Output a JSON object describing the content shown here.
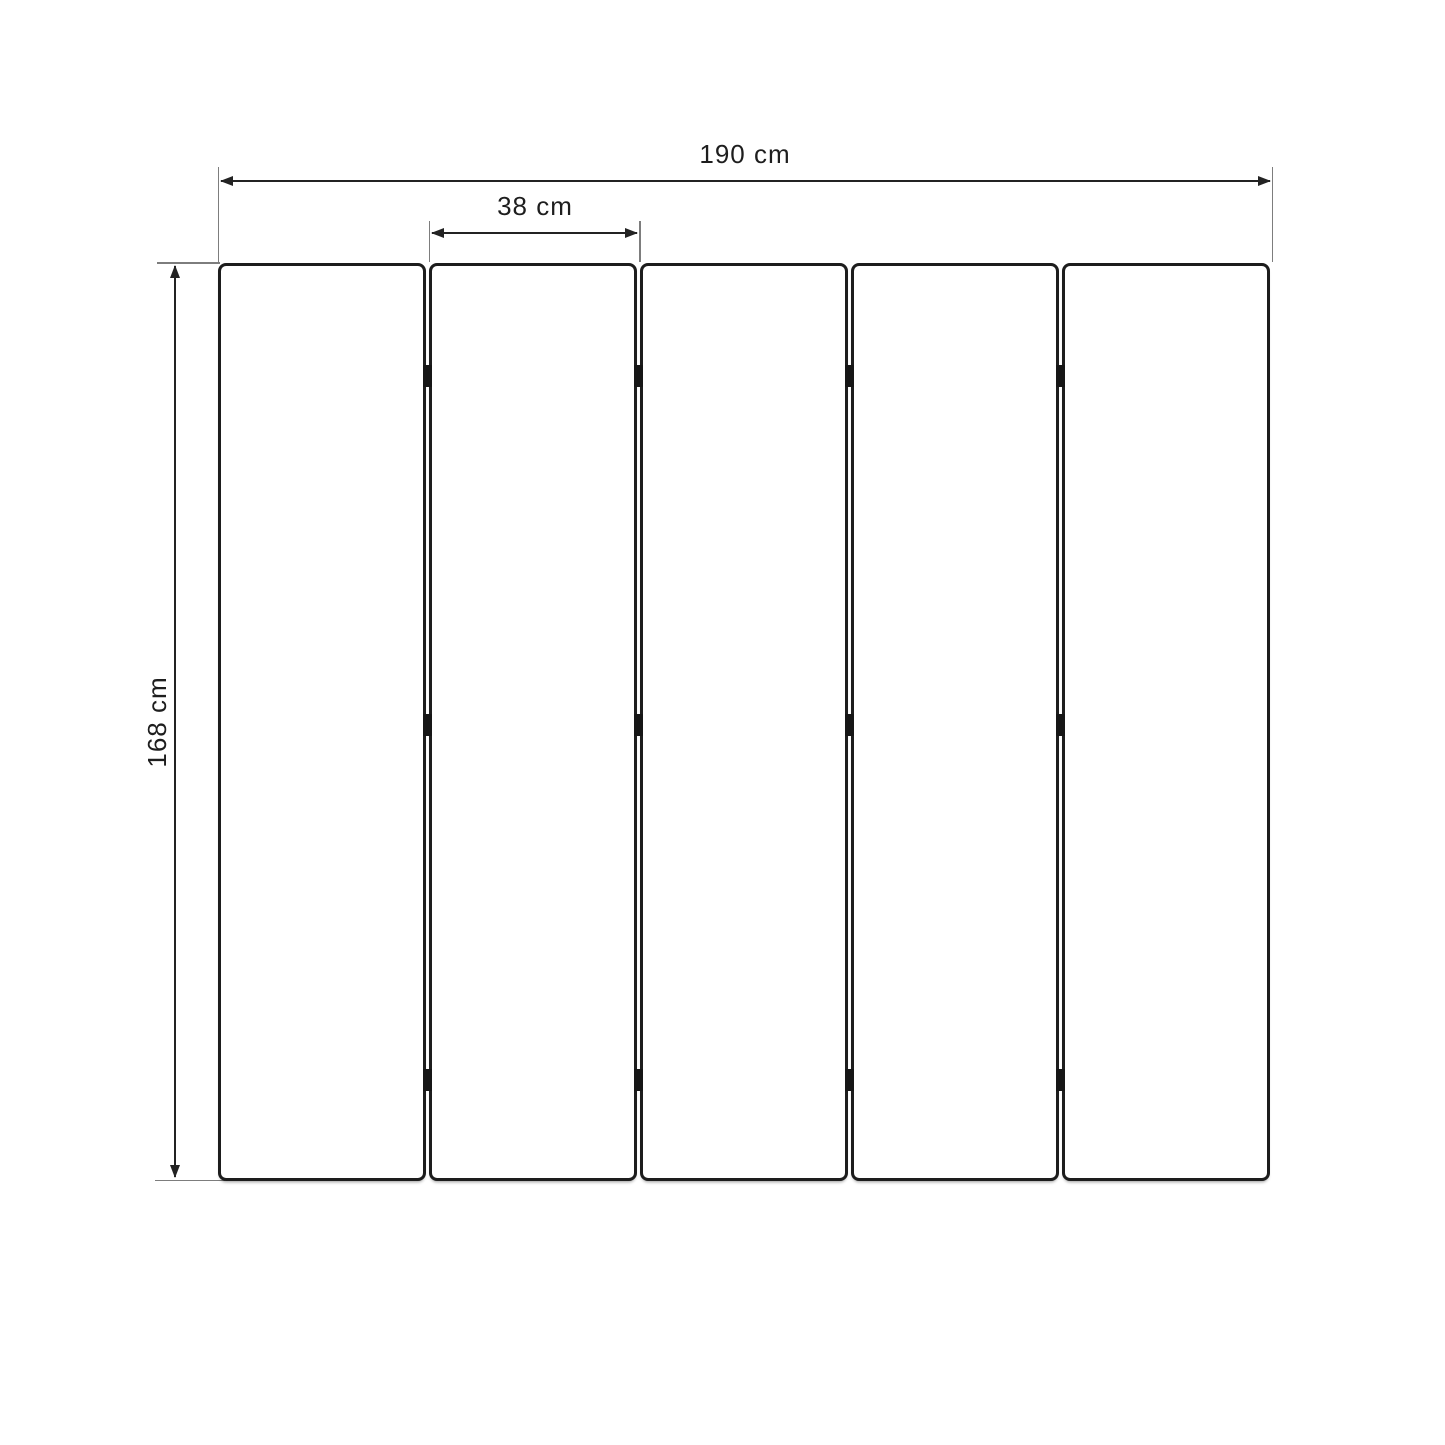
{
  "diagram": {
    "type": "technical-dimension-drawing",
    "subject": "five-panel folding screen (front view)",
    "dimensions": {
      "total_width": {
        "label": "190 cm"
      },
      "panel_width": {
        "label": "38 cm"
      },
      "height": {
        "label": "168 cm"
      }
    },
    "panels": {
      "count": 5,
      "hinge_rows_pct": [
        12.3,
        50.3,
        89.0
      ]
    },
    "colors": {
      "line": "#232323",
      "extension_line": "#7d7d7d",
      "panel_border": "#1d1d1d",
      "hinge": "#161616",
      "background": "#ffffff",
      "text": "#1e1e1e"
    }
  }
}
